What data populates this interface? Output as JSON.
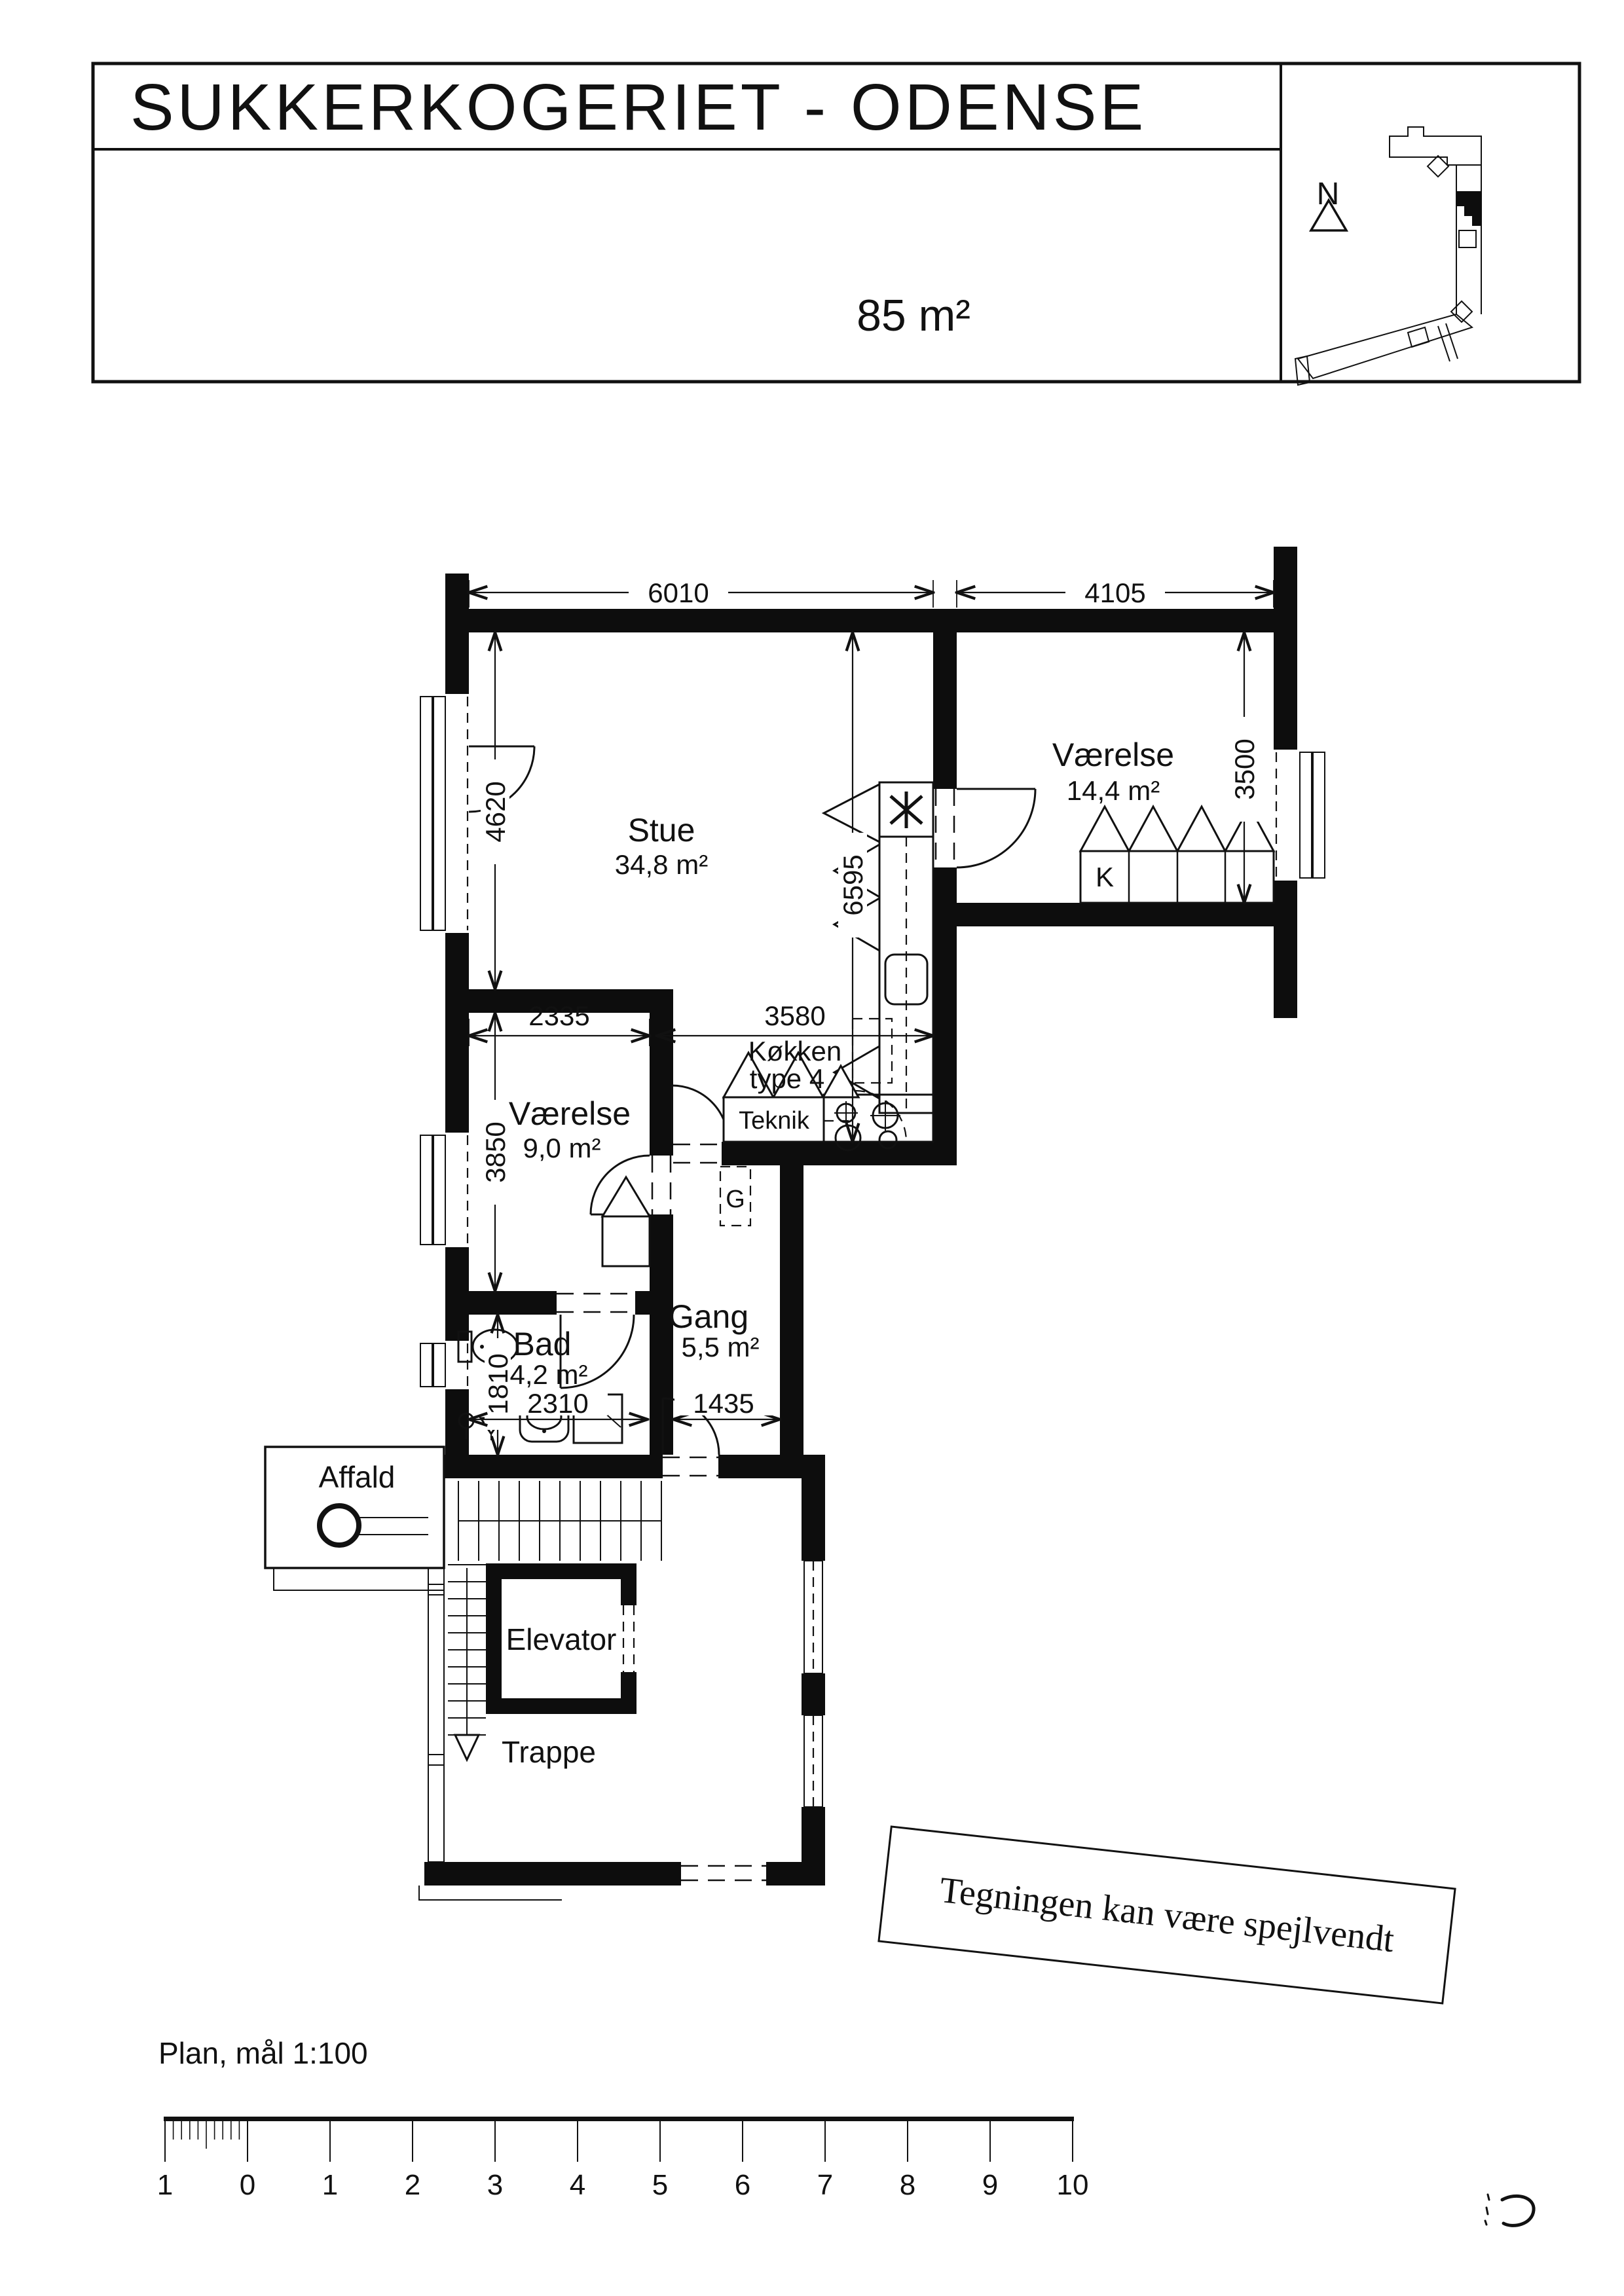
{
  "title_block": {
    "project": "SUKKERKOGERIET - ODENSE",
    "area_label": "85 m²",
    "north": "N"
  },
  "plan": {
    "rooms": [
      {
        "id": "stue",
        "name": "Stue",
        "area": "34,8 m²"
      },
      {
        "id": "vaerelse-14",
        "name": "Værelse",
        "area": "14,4 m²"
      },
      {
        "id": "vaerelse-9",
        "name": "Værelse",
        "area": "9,0 m²"
      },
      {
        "id": "bad",
        "name": "Bad",
        "area": "4,2 m²"
      },
      {
        "id": "gang",
        "name": "Gang",
        "area": "5,5 m²"
      }
    ],
    "koekken_line1": "Køkken",
    "koekken_line2": "type 4",
    "labels": {
      "teknik": "Teknik",
      "garderobe": "G",
      "skab": "K",
      "elevator": "Elevator",
      "trappe": "Trappe",
      "affald": "Affald"
    },
    "dims": {
      "stue_w": "6010",
      "v14_w": "4105",
      "stue_h": "4620",
      "v14_h": "3500",
      "kitchen_h": "6595",
      "koekken_w": "3580",
      "v9_w": "2335",
      "v9_h": "3850",
      "bad_h": "1810",
      "bad_w": "2310",
      "gang_w": "1435"
    }
  },
  "note": "Tegningen kan være spejlvendt",
  "footer": {
    "scale_label": "Plan, mål 1:100",
    "ruler_ticks": [
      "1",
      "0",
      "1",
      "2",
      "3",
      "4",
      "5",
      "6",
      "7",
      "8",
      "9",
      "10"
    ]
  }
}
